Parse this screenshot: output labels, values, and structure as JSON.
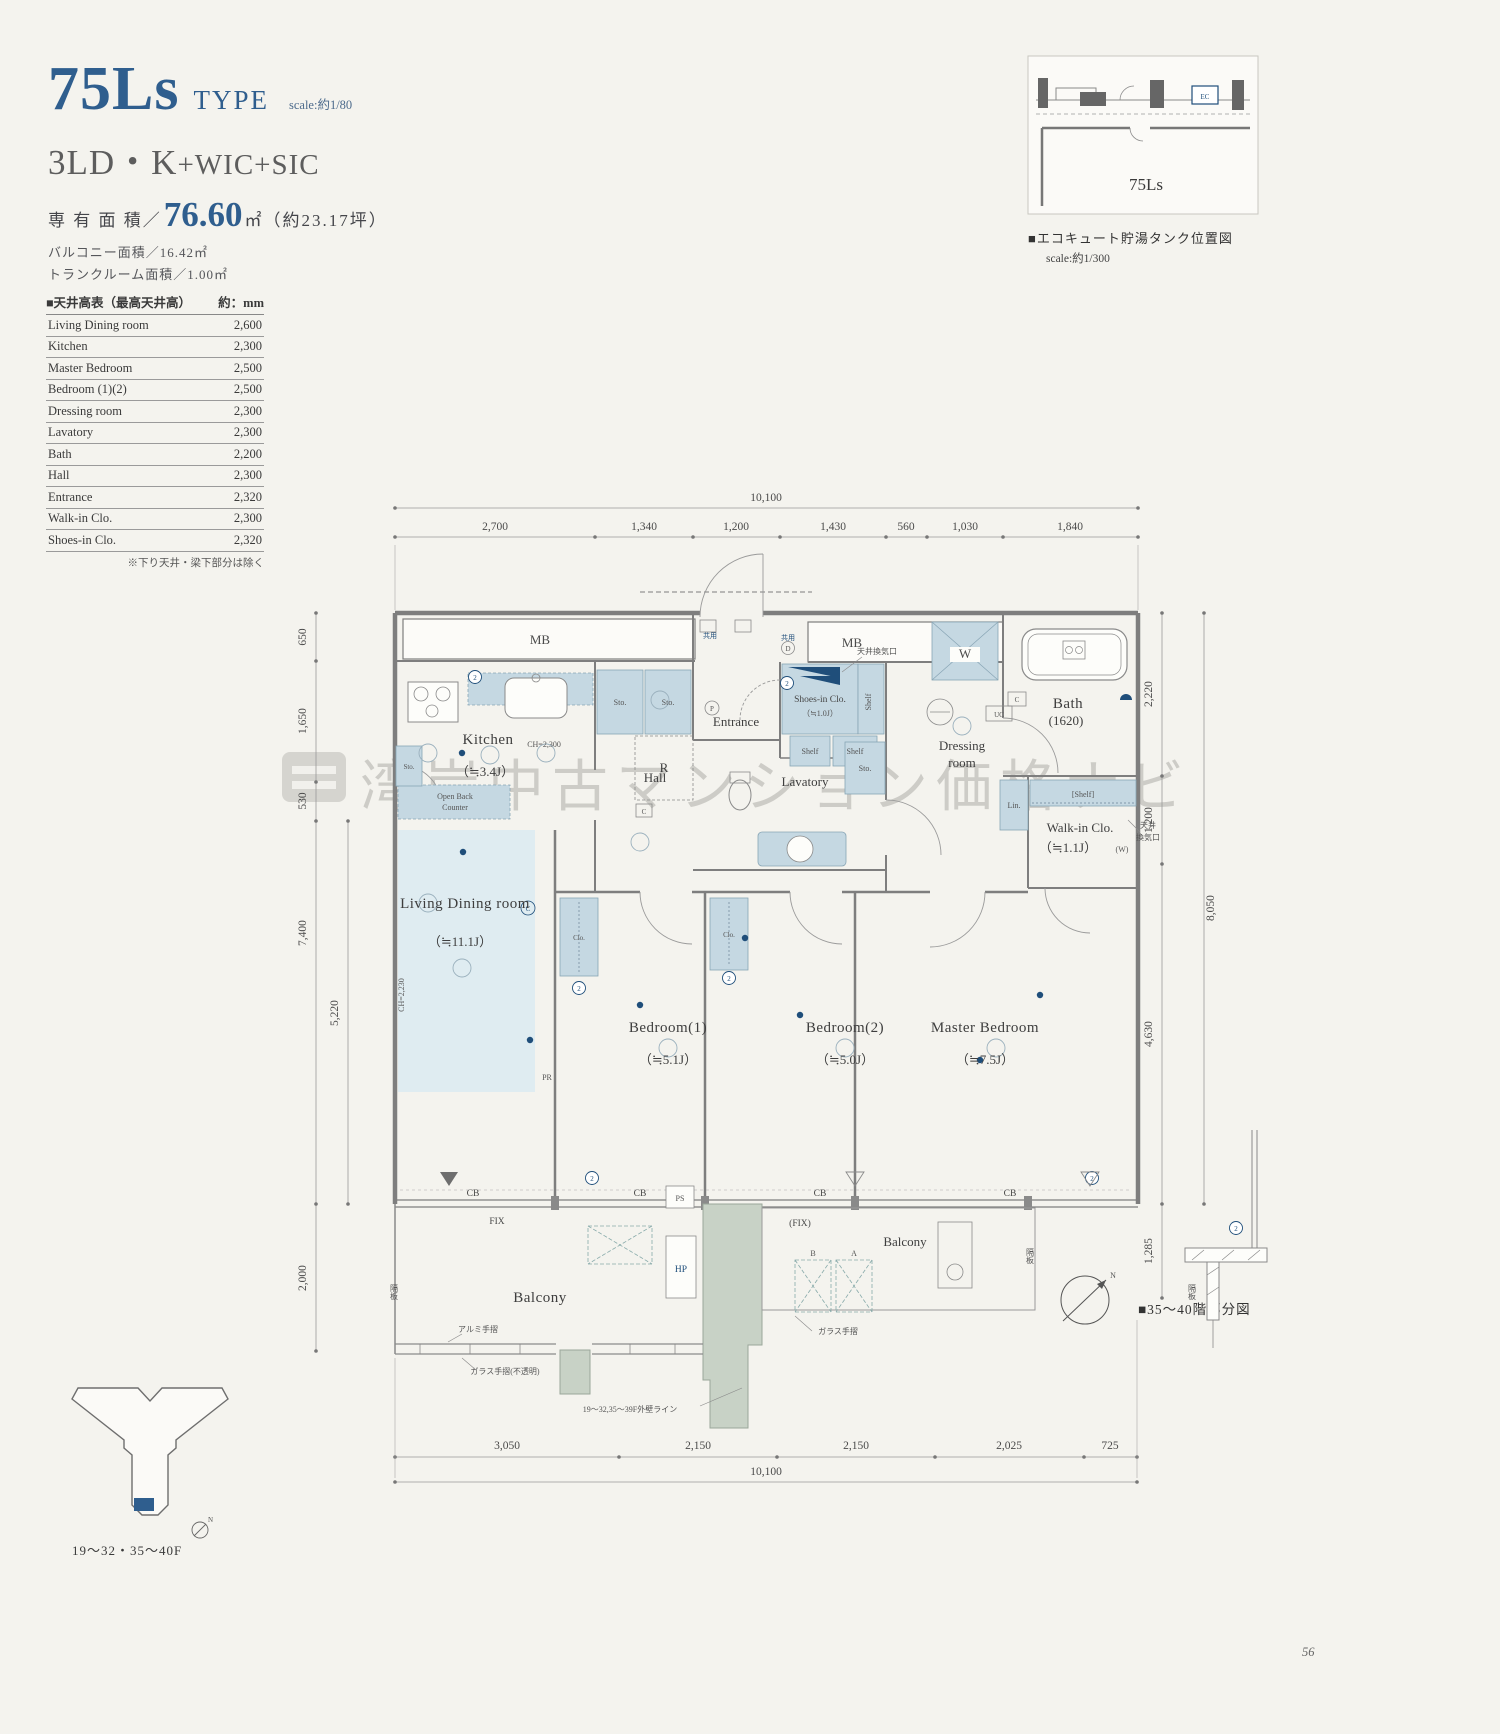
{
  "header": {
    "type_name": "75Ls",
    "type_suffix": "TYPE",
    "scale_note": "scale:約1/80",
    "layout_main": "3LD・K",
    "layout_sub": "+WIC+SIC",
    "area_label": "専 有 面 積／",
    "area_value": "76.60",
    "area_unit": "㎡（約23.17坪）",
    "balcony_area": "バルコニー面積／16.42㎡",
    "trunk_area": "トランクルーム面積／1.00㎡"
  },
  "ceiling_table": {
    "title": "■天井高表（最高天井高）",
    "unit": "約：mm",
    "rows": [
      {
        "label": "Living Dining room",
        "value": "2,600"
      },
      {
        "label": "Kitchen",
        "value": "2,300"
      },
      {
        "label": "Master Bedroom",
        "value": "2,500"
      },
      {
        "label": "Bedroom (1)(2)",
        "value": "2,500"
      },
      {
        "label": "Dressing room",
        "value": "2,300"
      },
      {
        "label": "Lavatory",
        "value": "2,300"
      },
      {
        "label": "Bath",
        "value": "2,200"
      },
      {
        "label": "Hall",
        "value": "2,300"
      },
      {
        "label": "Entrance",
        "value": "2,320"
      },
      {
        "label": "Walk-in Clo.",
        "value": "2,300"
      },
      {
        "label": "Shoes-in Clo.",
        "value": "2,320"
      }
    ],
    "footnote": "※下り天井・梁下部分は除く"
  },
  "keymap": {
    "unit_label": "75Ls",
    "ec_label": "EC",
    "caption": "■エコキュート貯湯タンク位置図",
    "scale_note": "scale:約1/300"
  },
  "plan": {
    "dims": {
      "top_total": "10,100",
      "top": [
        "2,700",
        "1,340",
        "1,200",
        "1,430",
        "560",
        "1,030",
        "1,840"
      ],
      "left": [
        "650",
        "1,650",
        "530",
        "7,400",
        "5,220",
        "2,000"
      ],
      "right": [
        "2,220",
        "1,200",
        "8,050",
        "4,630",
        "1,285"
      ],
      "bottom": [
        "3,050",
        "2,150",
        "2,150",
        "2,025",
        "725"
      ],
      "bottom_total": "10,100"
    },
    "rooms": {
      "mb": "MB",
      "kitchen": "Kitchen",
      "kitchen_size": "（≒3.4J）",
      "entrance": "Entrance",
      "hall": "Hall",
      "lavatory": "Lavatory",
      "dressing_1": "Dressing",
      "dressing_2": "room",
      "bath": "Bath",
      "bath_size": "(1620)",
      "shoes": "Shoes-in Clo.",
      "shoes_size": "（≒1.0J）",
      "wic": "Walk-in Clo.",
      "wic_size": "（≒1.1J）",
      "wic_w": "(W)",
      "ld": "Living Dining room",
      "ld_size": "（≒11.1J）",
      "b1": "Bedroom(1)",
      "b1_size": "（≒5.1J）",
      "b2": "Bedroom(2)",
      "b2_size": "（≒5.0J）",
      "master": "Master Bedroom",
      "master_size": "（≒7.5J）",
      "balcony": "Balcony"
    },
    "fixtures": {
      "sto": "Sto.",
      "clo": "Clo.",
      "shelf": "Shelf",
      "shelf_bracket": "[Shelf]",
      "lin": "Lin.",
      "r": "R",
      "c": "C",
      "w": "W",
      "uc": "UC",
      "cb": "CB",
      "fix": "FIX",
      "fix_paren": "(FIX)",
      "ps": "PS",
      "hp": "HP",
      "pr": "PR",
      "p": "P",
      "two": "2",
      "d": "D",
      "n": "N",
      "b": "B",
      "a": "A"
    },
    "notes": {
      "kyoyo": "共用",
      "vent": "天井換気口",
      "vent_1": "天井",
      "vent_2": "換気口",
      "ch_kitchen": "CH=2,300",
      "ch_ld": "CH=2,230",
      "open_back_1": "Open Back",
      "open_back_2": "Counter",
      "alumi": "アルミ手摺",
      "glass_opaque": "ガラス手摺(不透明)",
      "glass": "ガラス手摺",
      "kakuita": "隔板",
      "gaiheki": "19〜32,35〜39F外壁ライン"
    },
    "watermark": "湾岸中古マンション価格ナビ"
  },
  "partial_caption": "■35〜40階部分図",
  "building_key": {
    "caption": "19〜32・35〜40F"
  },
  "page_number": "56"
}
